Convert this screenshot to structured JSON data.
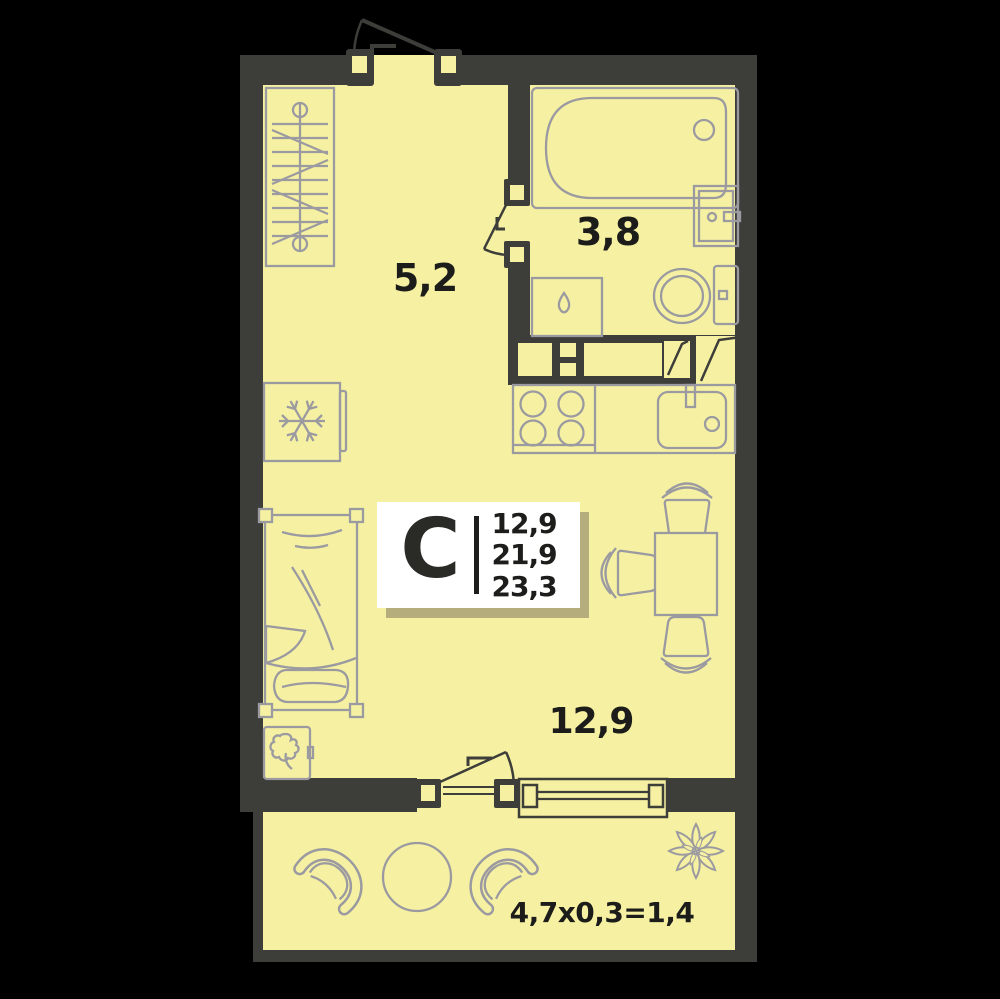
{
  "unit_card": {
    "type_label": "С",
    "area_values": [
      "12,9",
      "21,9",
      "23,3"
    ]
  },
  "room_labels": {
    "hallway_area": "5,2",
    "bathroom_area": "3,8",
    "living_area": "12,9",
    "balcony_formula": "4,7х0,3=1,4"
  },
  "icons": {
    "fridge": "snowflake-icon",
    "washing_machine": "droplet-icon",
    "balcony_decor": "flower-icon"
  },
  "colors": {
    "background": "#000000",
    "floor_fill": "#f6f1a2",
    "wall_fill": "#3d3d3a",
    "furniture_outline": "#9b9aa0",
    "label_text": "#1c1c1a",
    "card_background": "#ffffff",
    "card_shadow": "#b5ae7c"
  }
}
